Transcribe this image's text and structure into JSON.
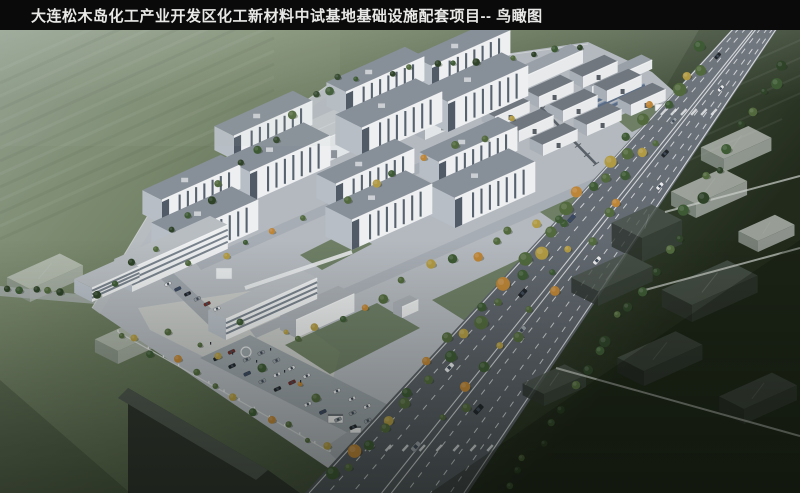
{
  "title_bar": {
    "title": "大连松木岛化工产业开发区化工新材料中试基地基础设施配套项目--  鸟瞰图"
  },
  "scene": {
    "type": "architectural-birdseye-rendering",
    "subject": "chemical new-material pilot-test base campus with lab blocks, warehouses, tank farm, offices, tree-lined arterial road and ghost context massing",
    "colors": {
      "title_bg": "#0a0a0a",
      "title_text": "#e8e8e6",
      "field_a": "#93a08f",
      "field_b": "#78876b",
      "field_c": "#5d6d51",
      "field_d": "#424f3b",
      "field_e": "#242c1e",
      "campus": "#b4b9bf",
      "plaza": "#c8cac7",
      "lot": "#9aa1a8",
      "inner_road": "#a4aab1",
      "slab_wall": "#edeff1",
      "slab_shadow": "#b7bec6",
      "slab_glass": "#3e4a58",
      "slab_roof": "#878f98",
      "slab_trim": "#f3f4f5",
      "ware_wall": "#e2e5e7",
      "ware_roof": "#c2c6ca",
      "ware_side": "#a9afb6",
      "shop_wall": "#e8eaeb",
      "shop_roof": "#70777f",
      "util_wall": "#e7e9eb",
      "util_roof": "#99a0a7",
      "stack": "#d5d8da",
      "tank": "#dde1e4",
      "pipe": "#596067",
      "solar": "#5b6d86",
      "solar_line": "#94a7c0",
      "office_wall": "#eceeef",
      "office_band": "#66717d",
      "office_roof": "#b8bdc2",
      "road": "#71787f",
      "road_low": "#52585f",
      "lane": "#eef0f2",
      "tree_a": "#3d5a34",
      "tree_b": "#51693d",
      "tree_c": "#2e4328",
      "tree_y": "#b19a44",
      "tree_o": "#bd8537",
      "ghost_wall_l": "#b7bdb8",
      "ghost_roof_l": "#c7ccc6",
      "ghost_side_l": "#99a09a",
      "ghost_wall_d": "#39413a",
      "ghost_roof_d": "#4a534b",
      "ghost_side_d": "#2d342e",
      "gate": "#f0f1f2",
      "wall_line": "#d3d6d7"
    },
    "platform": [
      [
        92,
        308
      ],
      [
        150,
        212
      ],
      [
        338,
        78
      ],
      [
        588,
        42
      ],
      [
        652,
        72
      ],
      [
        704,
        118
      ],
      [
        334,
        472
      ]
    ],
    "service_strip": [
      [
        92,
        308
      ],
      [
        150,
        212
      ],
      [
        338,
        78
      ],
      [
        344,
        84
      ],
      [
        158,
        218
      ],
      [
        100,
        314
      ]
    ],
    "fences": [
      [
        [
          92,
          308
        ],
        [
          150,
          212
        ]
      ],
      [
        [
          150,
          212
        ],
        [
          338,
          78
        ]
      ],
      [
        [
          338,
          78
        ],
        [
          588,
          44
        ]
      ]
    ],
    "inner_roads": [
      [
        [
          195,
          262
        ],
        [
          560,
          100
        ],
        [
          566,
          108
        ],
        [
          201,
          270
        ]
      ],
      [
        [
          250,
          330
        ],
        [
          640,
          158
        ],
        [
          646,
          166
        ],
        [
          256,
          338
        ]
      ],
      [
        [
          676,
          114
        ],
        [
          690,
          124
        ],
        [
          350,
          466
        ],
        [
          336,
          456
        ]
      ]
    ],
    "plaza": [
      [
        138,
        308
      ],
      [
        256,
        290
      ],
      [
        340,
        352
      ],
      [
        330,
        390
      ],
      [
        210,
        360
      ],
      [
        150,
        330
      ]
    ],
    "parking_lot": [
      [
        250,
        335
      ],
      [
        428,
        425
      ],
      [
        378,
        448
      ],
      [
        200,
        358
      ]
    ],
    "left_lot": [
      [
        160,
        278
      ],
      [
        172,
        272
      ],
      [
        234,
        330
      ],
      [
        222,
        338
      ]
    ],
    "entrance": [
      [
        324,
        448
      ],
      [
        356,
        426
      ],
      [
        380,
        448
      ],
      [
        348,
        470
      ]
    ],
    "spur_road": [
      [
        0,
        286
      ],
      [
        96,
        296
      ],
      [
        96,
        304
      ],
      [
        0,
        296
      ]
    ],
    "green_patches": [
      [
        [
          285,
          345
        ],
        [
          377,
          303
        ],
        [
          420,
          328
        ],
        [
          330,
          374
        ]
      ],
      [
        [
          432,
          300
        ],
        [
          522,
          258
        ],
        [
          560,
          280
        ],
        [
          470,
          324
        ]
      ],
      [
        [
          540,
          212
        ],
        [
          602,
          184
        ],
        [
          628,
          200
        ],
        [
          566,
          230
        ]
      ],
      [
        [
          300,
          255
        ],
        [
          350,
          230
        ],
        [
          372,
          244
        ],
        [
          322,
          270
        ]
      ],
      [
        [
          615,
          118
        ],
        [
          655,
          100
        ],
        [
          672,
          112
        ],
        [
          632,
          132
        ]
      ]
    ],
    "lab_blocks": [
      [
        448,
        132
      ],
      [
        362,
        158
      ],
      [
        250,
        202
      ],
      [
        455,
        228
      ],
      [
        352,
        250
      ],
      [
        178,
        266
      ]
    ],
    "warehouses": [
      [
        310,
        170,
        120,
        24,
        30
      ],
      [
        425,
        140,
        95,
        20,
        26
      ]
    ],
    "utility": [
      [
        510,
        96,
        80,
        13,
        14
      ],
      [
        592,
        96,
        66,
        9,
        12
      ]
    ],
    "chimney": [
      489,
      44,
      3.5,
      30
    ],
    "tanks": {
      "r": 3.2,
      "pts": [
        [
          472,
          67
        ],
        [
          481,
          65
        ],
        [
          490,
          63
        ],
        [
          499,
          61
        ],
        [
          474,
          75
        ],
        [
          483,
          73
        ],
        [
          492,
          71
        ],
        [
          501,
          69
        ]
      ]
    },
    "pipe_rack": [
      [
        524,
        90
      ],
      [
        596,
        164
      ]
    ],
    "workshops": [
      [
        583,
        88
      ],
      [
        607,
        102
      ],
      [
        539,
        108
      ],
      [
        631,
        116
      ],
      [
        563,
        122
      ],
      [
        495,
        128
      ],
      [
        587,
        136
      ],
      [
        519,
        142
      ],
      [
        543,
        156
      ]
    ],
    "workshop_size": [
      38,
      11,
      15
    ],
    "solar": {
      "x": 585,
      "y": 100,
      "rows": 5,
      "len": 52
    },
    "small_box": [
      402,
      318,
      18,
      11
    ],
    "corridor": [
      [
        245,
        288
      ],
      [
        352,
        252
      ]
    ],
    "fountain": [
      246,
      352,
      5
    ],
    "offices": {
      "o5": [
        92,
        302,
        52,
        14
      ],
      "o1": [
        132,
        292,
        105,
        24
      ],
      "o2": [
        226,
        340,
        100,
        21
      ],
      "o4": [
        296,
        338,
        64,
        18
      ],
      "bridge": [
        216,
        268,
        16,
        11
      ]
    },
    "wall": [
      [
        118,
        332
      ],
      [
        330,
        452
      ]
    ],
    "gates": {
      "main": [
        [
          328,
          414,
          15,
          9
        ],
        [
          350,
          426,
          11,
          7
        ]
      ],
      "secondary": [
        [
          655,
          104,
          12,
          7
        ]
      ]
    },
    "road": {
      "poly": [
        [
          733,
          28
        ],
        [
          778,
          28
        ],
        [
          468,
          493
        ],
        [
          305,
          493
        ]
      ],
      "top_l": 733,
      "top_r": 778,
      "bot_l": 305,
      "bot_r": 468,
      "lanes_dashed": [
        0.14,
        0.29,
        0.62,
        0.77,
        0.89
      ],
      "lanes_solid": [
        0.025,
        0.47,
        0.53,
        0.975
      ],
      "crossings": [
        {
          "y": 112,
          "n": 6
        },
        {
          "y": 448,
          "n": 9
        }
      ]
    },
    "road_cars": [
      {
        "t": 0.06,
        "lane": 0.2,
        "c": 0
      },
      {
        "t": 0.13,
        "lane": 0.72,
        "c": 1
      },
      {
        "t": 0.2,
        "lane": 0.38,
        "c": 2
      },
      {
        "t": 0.27,
        "lane": 0.62,
        "c": 0
      },
      {
        "t": 0.34,
        "lane": 0.85,
        "c": 1
      },
      {
        "t": 0.41,
        "lane": 0.15,
        "c": 3
      },
      {
        "t": 0.5,
        "lane": 0.75,
        "c": 1
      },
      {
        "t": 0.57,
        "lane": 0.3,
        "c": 0
      },
      {
        "t": 0.65,
        "lane": 0.55,
        "c": 2
      },
      {
        "t": 0.73,
        "lane": 0.22,
        "c": 1
      },
      {
        "t": 0.82,
        "lane": 0.68,
        "c": 0
      },
      {
        "t": 0.9,
        "lane": 0.45,
        "c": 2
      }
    ],
    "car_colors": [
      "#20252b",
      "#e9ebed",
      "#9aa1a8",
      "#3a4a66",
      "#7a2b26"
    ],
    "tree_belts": [
      {
        "from": [
          706,
          52
        ],
        "to": [
          336,
          476
        ],
        "n": 36,
        "rmin": 3.5,
        "rmax": 7,
        "jit": 9,
        "pal": "campus"
      },
      {
        "from": [
          788,
          64
        ],
        "to": [
          505,
          490
        ],
        "n": 26,
        "rmin": 3,
        "rmax": 6,
        "jit": 7,
        "pal": "dark"
      },
      {
        "from": [
          338,
          80
        ],
        "to": [
          580,
          48
        ],
        "n": 11,
        "rmin": 2.5,
        "rmax": 4,
        "jit": 4,
        "pal": "dark"
      },
      {
        "from": [
          100,
          298
        ],
        "to": [
          332,
          84
        ],
        "n": 14,
        "rmin": 2.5,
        "rmax": 4.5,
        "jit": 5,
        "pal": "dark"
      },
      {
        "from": [
          660,
          140
        ],
        "to": [
          445,
          425
        ],
        "n": 16,
        "rmin": 3,
        "rmax": 5.5,
        "jit": 8,
        "pal": "mixed"
      },
      {
        "from": [
          190,
          268
        ],
        "to": [
          520,
          120
        ],
        "n": 12,
        "rmin": 2.5,
        "rmax": 4.5,
        "jit": 6,
        "pal": "mixed"
      },
      {
        "from": [
          295,
          332
        ],
        "to": [
          560,
          215
        ],
        "n": 13,
        "rmin": 3,
        "rmax": 5,
        "jit": 8,
        "pal": "mixed"
      },
      {
        "from": [
          118,
          330
        ],
        "to": [
          326,
          448
        ],
        "n": 12,
        "rmin": 2.5,
        "rmax": 4.5,
        "jit": 6,
        "pal": "mixed"
      },
      {
        "from": [
          6,
          286
        ],
        "to": [
          60,
          292
        ],
        "n": 5,
        "rmin": 2.5,
        "rmax": 4,
        "jit": 3,
        "pal": "dark"
      }
    ],
    "plaza_trees": [
      [
        200,
        345
      ],
      [
        218,
        356
      ],
      [
        262,
        368
      ],
      [
        300,
        384
      ],
      [
        168,
        332
      ],
      [
        316,
        398
      ],
      [
        286,
        332
      ],
      [
        240,
        322
      ]
    ],
    "ghosts_light": [
      [
        724,
        172,
        52,
        26,
        13
      ],
      [
        696,
        218,
        56,
        28,
        14
      ],
      [
        758,
        252,
        40,
        22,
        11
      ],
      [
        30,
        302,
        58,
        26,
        13
      ],
      [
        118,
        364,
        56,
        26,
        13
      ]
    ],
    "ghosts_dark": [
      [
        642,
        262,
        44,
        34,
        24
      ],
      [
        598,
        306,
        60,
        30,
        15
      ],
      [
        692,
        322,
        72,
        34,
        17
      ],
      [
        644,
        386,
        64,
        30,
        15
      ],
      [
        744,
        424,
        58,
        28,
        15
      ],
      [
        544,
        406,
        46,
        24,
        12
      ]
    ],
    "wedge": {
      "body": [
        [
          128,
          388
        ],
        [
          268,
          470
        ],
        [
          300,
          493
        ],
        [
          128,
          493
        ]
      ],
      "top": [
        [
          128,
          388
        ],
        [
          268,
          470
        ],
        [
          256,
          480
        ],
        [
          118,
          398
        ]
      ]
    },
    "paths": [
      [
        [
          665,
          212
        ],
        [
          800,
          176
        ]
      ],
      [
        [
          645,
          290
        ],
        [
          800,
          248
        ]
      ],
      [
        [
          556,
          368
        ],
        [
          800,
          436
        ]
      ]
    ],
    "furrows": {
      "left_ys": [
        70,
        96,
        122,
        148,
        174,
        200,
        226
      ],
      "right_ys": [
        60,
        90,
        120,
        150,
        180
      ]
    }
  }
}
